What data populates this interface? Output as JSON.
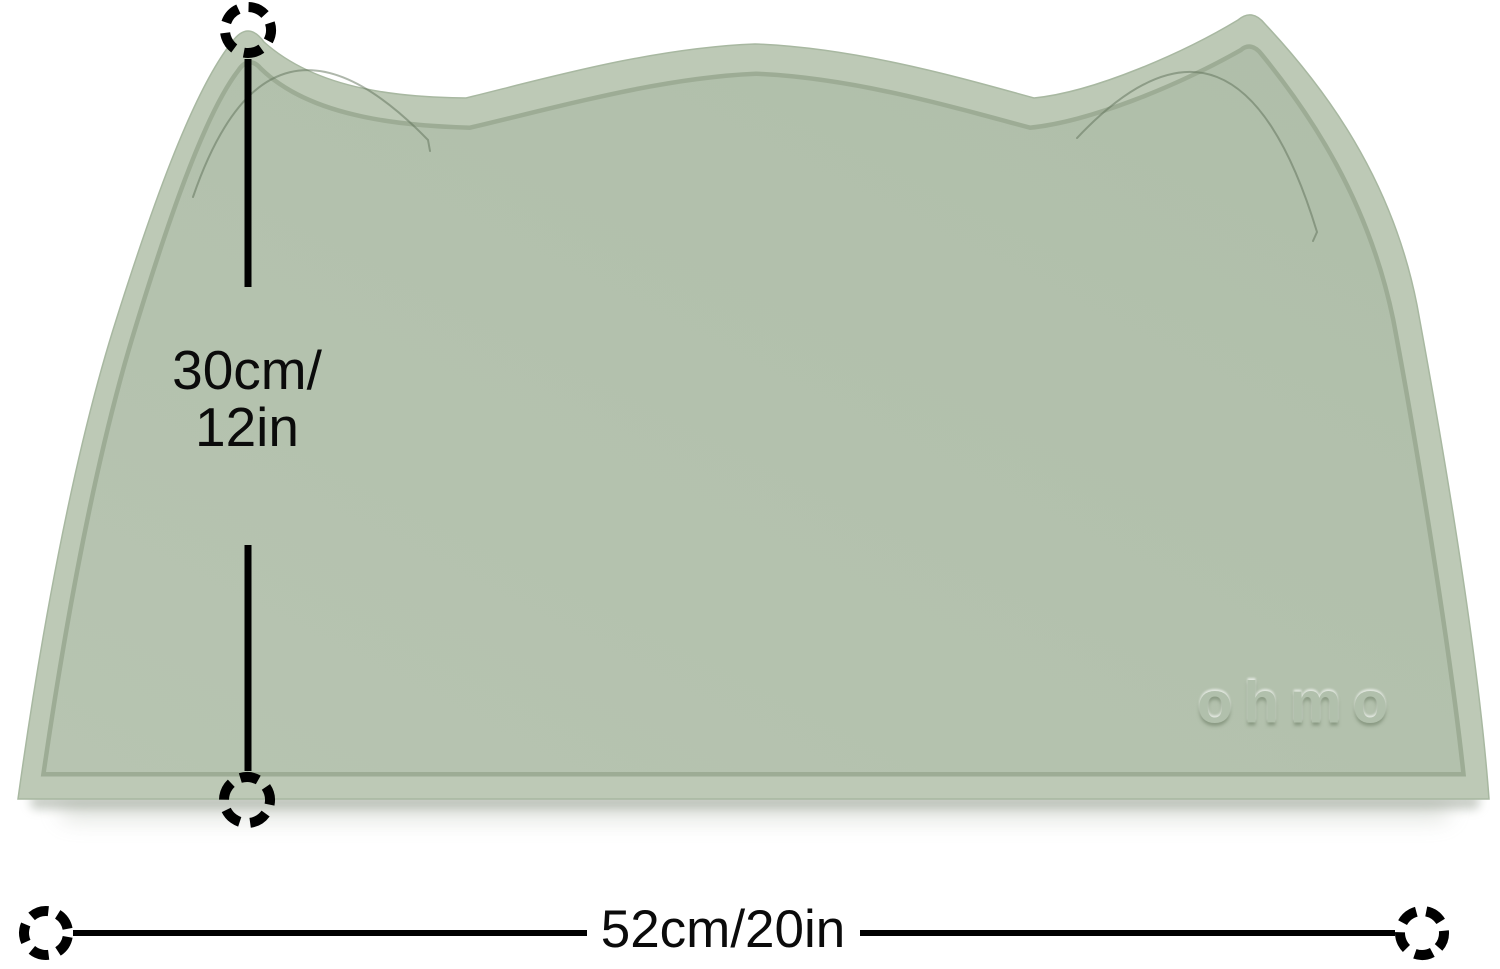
{
  "mat": {
    "brand_embossed_text": "OHMO",
    "colors": {
      "surface": "#b3c1ac",
      "rim": "#bdc9b6",
      "groove": "#87997e",
      "crease": "#5d6f57",
      "shadow": "#8e9889"
    }
  },
  "dimensions": {
    "height": {
      "line1": "30cm/",
      "line2": "12in"
    },
    "width": {
      "label": "52cm/20in"
    },
    "annotation_color": "#000000",
    "marker_icon": "dashed-circle-marker"
  },
  "background_color": "#ffffff"
}
